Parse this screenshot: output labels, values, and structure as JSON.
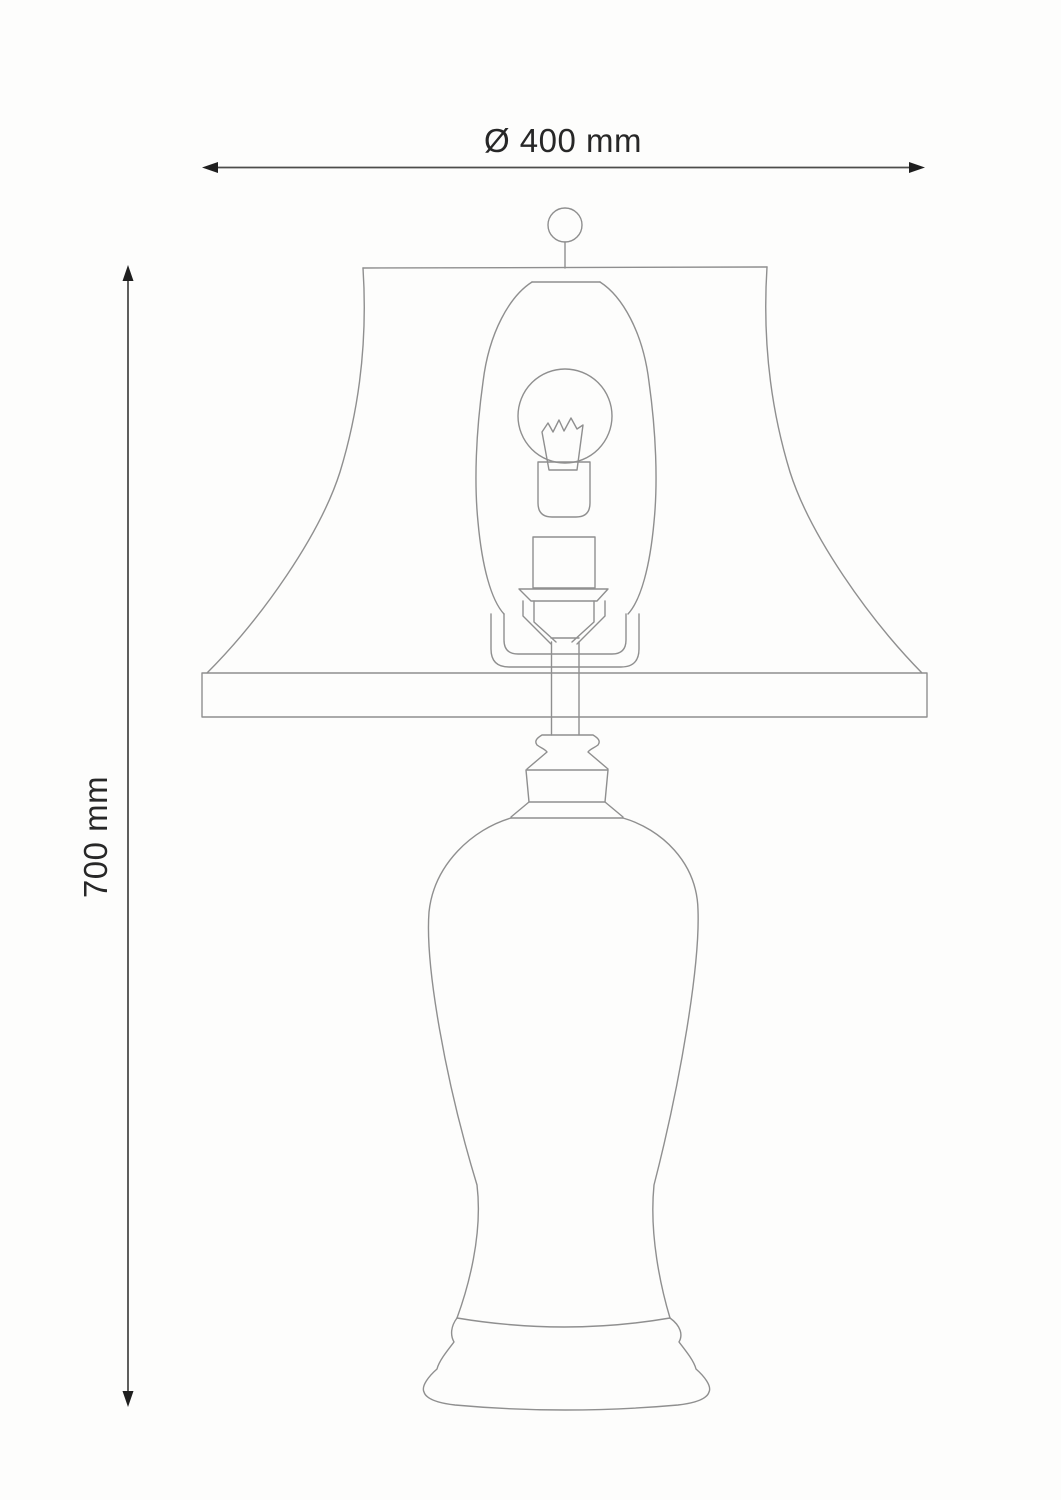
{
  "diagram": {
    "width_dimension": {
      "label": "Ø 400 mm",
      "value_mm": 400
    },
    "height_dimension": {
      "label": "700 mm",
      "value_mm": 700
    }
  },
  "colors": {
    "background": "#fdfdfc",
    "line": "#8f8f8f",
    "dimension_line": "#4d4d4b",
    "arrow": "#1f1f1f",
    "text": "#272727"
  }
}
